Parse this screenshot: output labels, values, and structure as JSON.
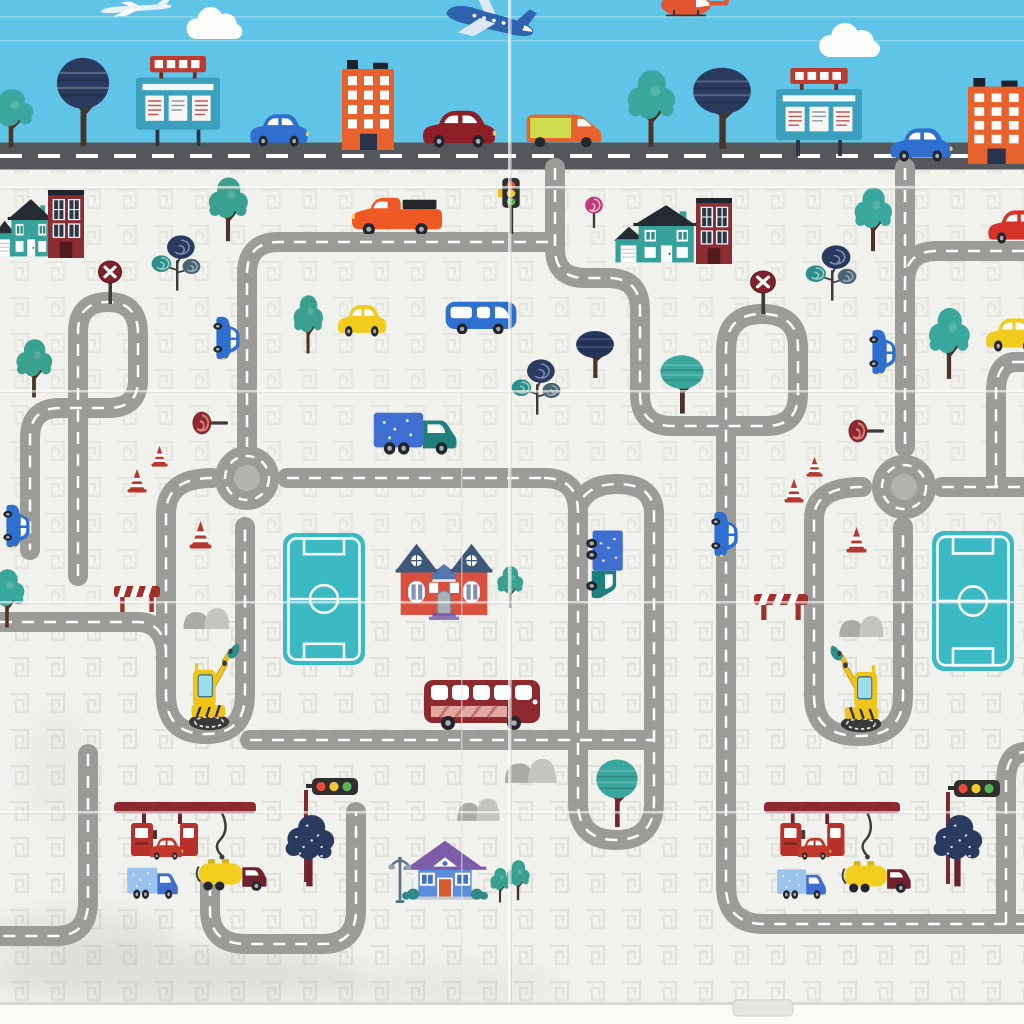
{
  "meta": {
    "description": "foldable kids play mat printed with a cartoon city road map",
    "width": 1024,
    "height": 1024
  },
  "palette": {
    "sky": "#5fc4e7",
    "mat": "#f1f1ee",
    "road": "#9b9b98",
    "road_dash": "#ffffff",
    "main_street": "#56575a",
    "roundabout_disc": "#b2b2af",
    "field_teal": "#3bbac3",
    "maroon": "#8c2a30",
    "teal": "#37a29b",
    "navy": "#2a3b5f",
    "orange": "#e8622d",
    "yellow": "#f0cc1f",
    "blue": "#2f6fd0"
  },
  "sky": {
    "objects": [
      {
        "name": "small-plane",
        "sym": "plane",
        "x": 94,
        "y": 0,
        "w": 80,
        "h": 16,
        "color": "#e6f2f8",
        "c2": "#ffffff",
        "rot": -4
      },
      {
        "name": "airplane",
        "sym": "plane",
        "x": 438,
        "y": -4,
        "w": 100,
        "h": 46,
        "color": "#2f63ae",
        "c2": "#dce9f5",
        "rot": 14
      },
      {
        "name": "helicopter",
        "sym": "heli",
        "x": 652,
        "y": -14,
        "w": 80,
        "h": 32,
        "color": "#e2552f"
      },
      {
        "name": "cloud",
        "sym": "cloud",
        "x": 182,
        "y": 4,
        "w": 64,
        "h": 36
      },
      {
        "name": "cloud",
        "sym": "cloud",
        "x": 814,
        "y": 20,
        "w": 70,
        "h": 38
      },
      {
        "name": "tree-bushy",
        "sym": "bushy",
        "x": -16,
        "y": 86,
        "w": 54,
        "h": 64,
        "color": "#3aa79e"
      },
      {
        "name": "tree-round-navy",
        "sym": "tree-round",
        "x": 54,
        "y": 56,
        "w": 58,
        "h": 94,
        "color": "#2a3b5f"
      },
      {
        "name": "billboard",
        "sym": "billboard",
        "x": 136,
        "y": 56,
        "w": 84,
        "h": 90,
        "color": "#3aa0bd",
        "c2": "#bf3a2e"
      },
      {
        "name": "car-blue",
        "sym": "car",
        "x": 248,
        "y": 110,
        "w": 62,
        "h": 37,
        "color": "#2f6fd0"
      },
      {
        "name": "building-orange",
        "sym": "building-orange",
        "x": 342,
        "y": 60,
        "w": 52,
        "h": 90,
        "color": "#e8622d"
      },
      {
        "name": "car-darkred",
        "sym": "car",
        "x": 420,
        "y": 106,
        "w": 78,
        "h": 42,
        "color": "#8e1f26"
      },
      {
        "name": "van-orange",
        "sym": "van-panel",
        "x": 524,
        "y": 108,
        "w": 80,
        "h": 40,
        "color": "#e8622d",
        "c2": "#cddd4e"
      },
      {
        "name": "tree-bushy",
        "sym": "bushy",
        "x": 622,
        "y": 66,
        "w": 58,
        "h": 84,
        "color": "#3aa79e"
      },
      {
        "name": "tree-round-navy",
        "sym": "tree-round",
        "x": 690,
        "y": 66,
        "w": 64,
        "h": 86,
        "color": "#2a3b5f"
      },
      {
        "name": "billboard",
        "sym": "billboard",
        "x": 776,
        "y": 68,
        "w": 86,
        "h": 88,
        "color": "#3aa0bd",
        "c2": "#bf3a2e"
      },
      {
        "name": "car-blue",
        "sym": "car",
        "x": 888,
        "y": 124,
        "w": 66,
        "h": 38,
        "color": "#2f6fd0"
      },
      {
        "name": "building-orange",
        "sym": "building-orange",
        "x": 968,
        "y": 78,
        "w": 56,
        "h": 86,
        "color": "#e8622d"
      }
    ]
  },
  "mat": {
    "roads": [
      {
        "name": "main-street",
        "d": "M 0 156 H 1024",
        "width": 27,
        "color": "#56575a",
        "dash": "22 16",
        "dash_width": 4
      },
      {
        "name": "north-connector",
        "d": "M 555 168 V 248 Q 555 278 585 278 H 608 Q 640 278 640 310 V 394 Q 640 426 672 426 H 766 Q 798 426 798 394 V 348 Q 798 314 762 314 Q 726 314 726 350 V 886 Q 726 924 764 924 H 1024"
      },
      {
        "name": "southeast-exit",
        "d": "M 1006 924 V 782 Q 1006 754 1024 752"
      },
      {
        "name": "east-connector",
        "d": "M 905 168 V 447"
      },
      {
        "name": "east-spur-top",
        "d": "M 1024 251 H 937 Q 907 251 905 279"
      },
      {
        "name": "east-spur-mid",
        "d": "M 1024 362 H 1014 Q 996 364 996 392 V 487"
      },
      {
        "name": "east-roundabout-right-arm",
        "d": "M 942 487 H 1024"
      },
      {
        "name": "east-pocket-loop",
        "d": "M 862 487 Q 814 487 814 519 V 696 Q 814 736 859 736 Q 903 736 903 696 V 527"
      },
      {
        "name": "west-top-road",
        "d": "M 548 242 H 279 Q 247 242 247 274 V 447"
      },
      {
        "name": "west-pocket-loop",
        "d": "M 212 478 Q 166 478 166 514 V 694 Q 166 734 206 734 Q 245 734 245 694 V 527"
      },
      {
        "name": "west-roundabout-right-arm",
        "d": "M 287 478 H 548"
      },
      {
        "name": "center-loop",
        "d": "M 544 478 Q 578 478 578 512 V 802 Q 578 840 616 840 Q 654 840 654 802 V 514 Q 654 484 617 484 Q 590 484 580 502"
      },
      {
        "name": "bus-road",
        "d": "M 250 740 H 654"
      },
      {
        "name": "west-edge-branch",
        "d": "M 0 622 H 138 Q 162 622 166 650"
      },
      {
        "name": "northwest-loop",
        "d": "M 78 576 V 332 Q 78 302 108 302 Q 138 302 138 334 V 380 Q 138 408 108 408 H 60 Q 30 408 30 438 V 550"
      },
      {
        "name": "southwest-exit",
        "d": "M 88 754 V 901 Q 88 936 56 936 H 0"
      },
      {
        "name": "south-gas-road",
        "d": "M 210 884 V 910 Q 210 944 246 944 H 322 Q 356 944 356 910 V 812"
      }
    ],
    "roundabouts": [
      {
        "name": "roundabout-west",
        "cx": 247,
        "cy": 478
      },
      {
        "name": "roundabout-east",
        "cx": 904,
        "cy": 487
      }
    ],
    "objects": [
      {
        "name": "house-teal",
        "sym": "house-teal",
        "x": -6,
        "y": 196,
        "w": 58,
        "h": 62,
        "color": "#37a29b"
      },
      {
        "name": "building-maroon",
        "sym": "building-maroon",
        "x": 48,
        "y": 190,
        "w": 36,
        "h": 68,
        "color": "#8c2c33"
      },
      {
        "name": "tree-bushy",
        "sym": "bushy",
        "x": 204,
        "y": 174,
        "w": 48,
        "h": 70,
        "color": "#3aa08f"
      },
      {
        "name": "swirl-trees",
        "sym": "swirl3",
        "x": 150,
        "y": 234,
        "w": 52,
        "h": 58,
        "color": "#2f8f8a",
        "c2": "#2a3b5f",
        "c3": "#4a6473"
      },
      {
        "name": "no-entry-sign",
        "sym": "sign-x",
        "x": 96,
        "y": 260,
        "w": 28,
        "h": 44,
        "color": "#7e222b"
      },
      {
        "name": "pickup-orange",
        "sym": "pickup",
        "x": 350,
        "y": 194,
        "w": 94,
        "h": 40,
        "color": "#ef5a24"
      },
      {
        "name": "traffic-light",
        "sym": "tl-v",
        "x": 498,
        "y": 178,
        "w": 26,
        "h": 56
      },
      {
        "name": "swirl-tree-pink",
        "sym": "swirl1",
        "x": 582,
        "y": 196,
        "w": 24,
        "h": 32,
        "color": "#c23a7a"
      },
      {
        "name": "house-teal",
        "sym": "house-teal",
        "x": 614,
        "y": 202,
        "w": 82,
        "h": 62,
        "color": "#37a29b"
      },
      {
        "name": "building-maroon",
        "sym": "building-maroon",
        "x": 696,
        "y": 198,
        "w": 36,
        "h": 66,
        "color": "#8c2c33"
      },
      {
        "name": "no-entry-sign",
        "sym": "sign-x",
        "x": 748,
        "y": 270,
        "w": 30,
        "h": 44,
        "color": "#7e222b"
      },
      {
        "name": "swirl-trees",
        "sym": "swirl3",
        "x": 804,
        "y": 244,
        "w": 54,
        "h": 58,
        "color": "#2f8f8a",
        "c2": "#2a3b5f",
        "c3": "#4a6473"
      },
      {
        "name": "tree-bushy",
        "sym": "bushy",
        "x": 850,
        "y": 184,
        "w": 46,
        "h": 70,
        "color": "#3aa79e"
      },
      {
        "name": "car-red-convertible",
        "sym": "car",
        "x": 986,
        "y": 206,
        "w": 64,
        "h": 38,
        "color": "#d6342a"
      },
      {
        "name": "car-yellow",
        "sym": "car",
        "x": 336,
        "y": 301,
        "w": 52,
        "h": 36,
        "color": "#f0cc1f"
      },
      {
        "name": "van-blue",
        "sym": "van",
        "x": 444,
        "y": 296,
        "w": 74,
        "h": 38,
        "color": "#2f6fd0"
      },
      {
        "name": "car-blue-vertical",
        "sym": "car",
        "x": 205,
        "y": 323,
        "w": 46,
        "h": 30,
        "rot": 90,
        "color": "#2f6fd0"
      },
      {
        "name": "tree-bushy",
        "sym": "bushy",
        "x": 290,
        "y": 292,
        "w": 36,
        "h": 64,
        "color": "#3aa08f"
      },
      {
        "name": "tree-bushy",
        "sym": "bushy",
        "x": 12,
        "y": 336,
        "w": 44,
        "h": 64,
        "color": "#3aa08f"
      },
      {
        "name": "tree-round-teal",
        "sym": "tree-round",
        "x": 658,
        "y": 354,
        "w": 48,
        "h": 62,
        "color": "#3aa79e"
      },
      {
        "name": "tree-round-navy",
        "sym": "tree-round",
        "x": 574,
        "y": 330,
        "w": 42,
        "h": 50,
        "color": "#26355c"
      },
      {
        "name": "swirl-trees",
        "sym": "swirl3",
        "x": 510,
        "y": 358,
        "w": 52,
        "h": 58,
        "color": "#2f8f8a",
        "c2": "#2a3b5f",
        "c3": "#4a6473"
      },
      {
        "name": "tree-bushy",
        "sym": "bushy",
        "x": 924,
        "y": 304,
        "w": 50,
        "h": 78,
        "color": "#3aa79e"
      },
      {
        "name": "car-yellow",
        "sym": "car",
        "x": 984,
        "y": 314,
        "w": 58,
        "h": 38,
        "color": "#f0cc1f"
      },
      {
        "name": "car-blue-vertical",
        "sym": "car",
        "x": 860,
        "y": 337,
        "w": 48,
        "h": 30,
        "rot": 90,
        "color": "#2f6fd0"
      },
      {
        "name": "truck-teal-delivery",
        "sym": "truck-box",
        "x": 372,
        "y": 408,
        "w": 88,
        "h": 48,
        "color": "#1f7f7c",
        "c2": "#3f6fd0"
      },
      {
        "name": "lollipop-sign",
        "sym": "lollipop",
        "x": 192,
        "y": 410,
        "w": 36,
        "h": 26,
        "color": "#8c2a30"
      },
      {
        "name": "lollipop-sign",
        "sym": "lollipop",
        "x": 848,
        "y": 418,
        "w": 36,
        "h": 26,
        "color": "#8c2a30"
      },
      {
        "name": "traffic-cone",
        "sym": "cone",
        "x": 151,
        "y": 445,
        "w": 17,
        "h": 22,
        "color": "#b5392d"
      },
      {
        "name": "traffic-cone",
        "sym": "cone",
        "x": 127,
        "y": 468,
        "w": 20,
        "h": 25,
        "color": "#b5392d"
      },
      {
        "name": "traffic-cone",
        "sym": "cone",
        "x": 189,
        "y": 520,
        "w": 23,
        "h": 29,
        "color": "#b5392d"
      },
      {
        "name": "traffic-cone",
        "sym": "cone",
        "x": 806,
        "y": 456,
        "w": 17,
        "h": 21,
        "color": "#b5392d"
      },
      {
        "name": "traffic-cone",
        "sym": "cone",
        "x": 784,
        "y": 478,
        "w": 20,
        "h": 25,
        "color": "#b5392d"
      },
      {
        "name": "traffic-cone",
        "sym": "cone",
        "x": 846,
        "y": 526,
        "w": 21,
        "h": 27,
        "color": "#b5392d"
      },
      {
        "name": "sports-field",
        "sym": "field",
        "x": 283,
        "y": 533,
        "w": 82,
        "h": 132,
        "color": "#3bbac3"
      },
      {
        "name": "sports-field",
        "sym": "field",
        "x": 932,
        "y": 531,
        "w": 82,
        "h": 140,
        "color": "#3bbac3"
      },
      {
        "name": "house-red-manor",
        "sym": "house-red",
        "x": 394,
        "y": 542,
        "w": 100,
        "h": 78,
        "color": "#d8503f"
      },
      {
        "name": "tree-bushy",
        "sym": "bushy",
        "x": 494,
        "y": 564,
        "w": 32,
        "h": 46,
        "color": "#3aa08f"
      },
      {
        "name": "pickup-teal-vertical",
        "sym": "truck-box",
        "x": 570,
        "y": 544,
        "w": 72,
        "h": 42,
        "rot": 90,
        "color": "#1f7f7c",
        "c2": "#3f6fd0"
      },
      {
        "name": "car-blue-vertical",
        "sym": "car",
        "x": 702,
        "y": 519,
        "w": 48,
        "h": 30,
        "rot": 90,
        "color": "#2f6fd0"
      },
      {
        "name": "car-blue-vertical",
        "sym": "car",
        "x": -5,
        "y": 511,
        "w": 46,
        "h": 30,
        "rot": 90,
        "color": "#2f6fd0"
      },
      {
        "name": "tree-bushy",
        "sym": "bushy",
        "x": -14,
        "y": 566,
        "w": 42,
        "h": 64,
        "color": "#3aa79e"
      },
      {
        "name": "road-barrier",
        "sym": "barrier",
        "x": 114,
        "y": 584,
        "w": 46,
        "h": 28,
        "color": "#a03028"
      },
      {
        "name": "road-barrier",
        "sym": "barrier",
        "x": 754,
        "y": 592,
        "w": 54,
        "h": 28,
        "color": "#a03028"
      },
      {
        "name": "rocks",
        "sym": "rocks",
        "x": 180,
        "y": 602,
        "w": 52,
        "h": 28
      },
      {
        "name": "rocks",
        "sym": "rocks",
        "x": 836,
        "y": 610,
        "w": 50,
        "h": 28
      },
      {
        "name": "excavator",
        "sym": "excavator",
        "x": 178,
        "y": 638,
        "w": 62,
        "h": 94,
        "flip": true,
        "color": "#f0c419",
        "c2": "#2e8f8a"
      },
      {
        "name": "excavator",
        "sym": "excavator",
        "x": 830,
        "y": 640,
        "w": 62,
        "h": 94,
        "color": "#f0c419",
        "c2": "#2e8f8a"
      },
      {
        "name": "bus-red",
        "sym": "bus",
        "x": 422,
        "y": 676,
        "w": 120,
        "h": 56,
        "color": "#8c2a30"
      },
      {
        "name": "tree-round-teal",
        "sym": "tree-round",
        "x": 594,
        "y": 758,
        "w": 46,
        "h": 72,
        "color": "#3aa79e",
        "c2": "#6e2230"
      },
      {
        "name": "rocks",
        "sym": "rocks",
        "x": 501,
        "y": 752,
        "w": 58,
        "h": 32
      },
      {
        "name": "rocks",
        "sym": "rocks",
        "x": 454,
        "y": 792,
        "w": 48,
        "h": 30
      },
      {
        "name": "traffic-light-horizontal",
        "sym": "tl-h",
        "x": 296,
        "y": 778,
        "w": 62,
        "h": 104,
        "c2": "#7a2a2e"
      },
      {
        "name": "traffic-light-horizontal",
        "sym": "tl-h",
        "x": 938,
        "y": 780,
        "w": 62,
        "h": 104,
        "c2": "#7a2a2e"
      },
      {
        "name": "tree-navy-speckled",
        "sym": "tree-blob",
        "x": 282,
        "y": 806,
        "w": 54,
        "h": 82,
        "color": "#2a3b5f",
        "c2": "#6e2230"
      },
      {
        "name": "tree-navy-speckled",
        "sym": "tree-blob",
        "x": 930,
        "y": 806,
        "w": 54,
        "h": 82,
        "color": "#2a3b5f",
        "c2": "#6e2230"
      },
      {
        "name": "gas-station",
        "sym": "gas",
        "x": 114,
        "y": 802,
        "w": 142,
        "h": 62,
        "color": "#8c2a30",
        "c2": "#b8322b"
      },
      {
        "name": "car-red",
        "sym": "car",
        "x": 148,
        "y": 835,
        "w": 36,
        "h": 25,
        "color": "#c0392b"
      },
      {
        "name": "truck-blue",
        "sym": "truck-box",
        "x": 126,
        "y": 864,
        "w": 54,
        "h": 36,
        "color": "#3f6fd0",
        "c2": "#9cc3ee"
      },
      {
        "name": "tanker-yellow",
        "sym": "tanker",
        "x": 194,
        "y": 856,
        "w": 78,
        "h": 36,
        "color": "#f2cf1f",
        "c3": "#6e2230"
      },
      {
        "name": "gas-station",
        "sym": "gas",
        "x": 764,
        "y": 802,
        "w": 136,
        "h": 62,
        "color": "#8c2a30",
        "c2": "#b8322b"
      },
      {
        "name": "car-red",
        "sym": "car",
        "x": 796,
        "y": 835,
        "w": 36,
        "h": 25,
        "color": "#c0392b"
      },
      {
        "name": "truck-blue",
        "sym": "truck-box",
        "x": 776,
        "y": 866,
        "w": 52,
        "h": 34,
        "color": "#3f6fd0",
        "c2": "#9cc3ee"
      },
      {
        "name": "tanker-yellow",
        "sym": "tanker",
        "x": 840,
        "y": 858,
        "w": 76,
        "h": 36,
        "color": "#f2cf1f",
        "c3": "#6e2230"
      },
      {
        "name": "house-blue-cottage",
        "sym": "house-blue",
        "x": 402,
        "y": 836,
        "w": 86,
        "h": 66,
        "color": "#5b8ddb",
        "c2": "#7b5ea7"
      },
      {
        "name": "street-lamp",
        "sym": "lamp",
        "x": 386,
        "y": 854,
        "w": 28,
        "h": 50
      },
      {
        "name": "tree-bushy",
        "sym": "bushy",
        "x": 488,
        "y": 866,
        "w": 24,
        "h": 38,
        "color": "#3aa08f"
      },
      {
        "name": "tree-bushy",
        "sym": "bushy",
        "x": 504,
        "y": 858,
        "w": 28,
        "h": 44,
        "color": "#3aa08f"
      }
    ]
  }
}
